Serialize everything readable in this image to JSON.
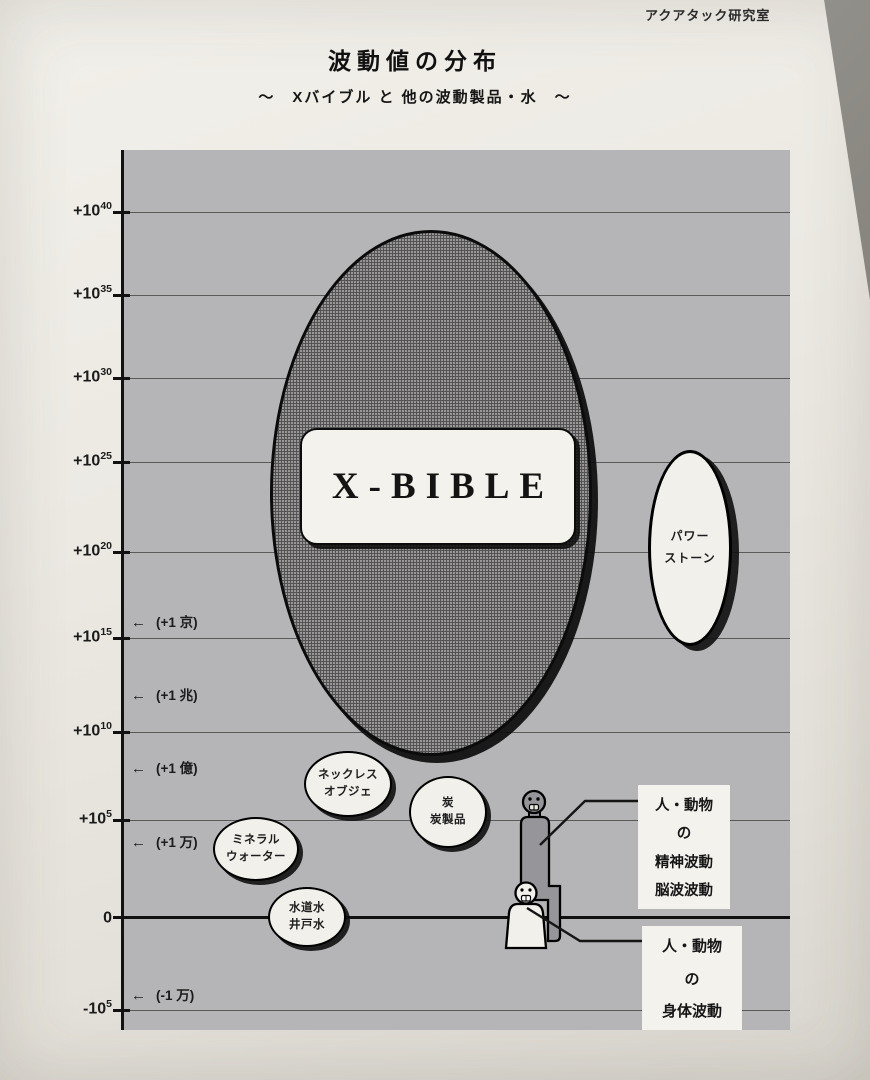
{
  "page": {
    "lab_name": "アクアタック研究室"
  },
  "header": {
    "title": "波動値の分布",
    "subtitle": "～　Xバイブル と 他の波動製品・水　～"
  },
  "y_axis": {
    "ticks": [
      {
        "base": "+10",
        "exp": "40"
      },
      {
        "base": "+10",
        "exp": "35"
      },
      {
        "base": "+10",
        "exp": "30"
      },
      {
        "base": "+10",
        "exp": "25"
      },
      {
        "base": "+10",
        "exp": "20"
      },
      {
        "base": "+10",
        "exp": "15"
      },
      {
        "base": "+10",
        "exp": "10"
      },
      {
        "base": "+10",
        "exp": "5"
      },
      {
        "base": "0",
        "exp": ""
      },
      {
        "base": "-10",
        "exp": "5"
      }
    ]
  },
  "unit_markers": [
    {
      "arrow": "←",
      "label": "(+1 京)"
    },
    {
      "arrow": "←",
      "label": "(+1 兆)"
    },
    {
      "arrow": "←",
      "label": "(+1 億)"
    },
    {
      "arrow": "←",
      "label": "(+1 万)"
    },
    {
      "arrow": "←",
      "label": "(-1 万)"
    }
  ],
  "items": {
    "xbible": {
      "label": "X-BIBLE"
    },
    "power_stone": {
      "line1": "パワー",
      "line2": "ストーン"
    },
    "necklace": {
      "line1": "ネックレス",
      "line2": "オブジェ"
    },
    "charcoal": {
      "line1": "炭",
      "line2": "炭製品"
    },
    "mineral_water": {
      "line1": "ミネラル",
      "line2": "ウォーター"
    },
    "tap_water": {
      "line1": "水道水",
      "line2": "井戸水"
    }
  },
  "callouts": {
    "mental": {
      "lines": [
        "人・動物",
        "の",
        "精神波動",
        "脳波波動"
      ]
    },
    "body": {
      "lines": [
        "人・動物",
        "の",
        "身体波動"
      ]
    }
  },
  "colors": {
    "paper": "#ece9e3",
    "plot_background": "#b5b4b7",
    "xbible_ellipse_fill": "#535356",
    "bubble_fill": "#f2f0ea",
    "ink": "#111111"
  },
  "chart_data": {
    "type": "scatter",
    "title": "波動値の分布",
    "subtitle": "～ Xバイブル と 他の波動製品・水 ～",
    "ylabel": "波動値",
    "y_scale": "log10, signed",
    "ylim_log10": [
      -5,
      40
    ],
    "grid": true,
    "y_ticks": [
      "+10^40",
      "+10^35",
      "+10^30",
      "+10^25",
      "+10^20",
      "+10^15",
      "+10^10",
      "+10^5",
      "0",
      "-10^5"
    ],
    "y_unit_annotations": [
      {
        "at": "+10^16",
        "label": "(+1 京)"
      },
      {
        "at": "+10^12",
        "label": "(+1 兆)"
      },
      {
        "at": "+10^8",
        "label": "(+1 億)"
      },
      {
        "at": "+10^4",
        "label": "(+1 万)"
      },
      {
        "at": "-10^4",
        "label": "(-1 万)"
      }
    ],
    "series": [
      {
        "name": "X-BIBLE",
        "shape": "large-ellipse",
        "range_log10": [
          9,
          39
        ]
      },
      {
        "name": "パワーストーン",
        "shape": "ellipse",
        "range_log10": [
          15,
          26
        ]
      },
      {
        "name": "ネックレス オブジェ",
        "shape": "circle",
        "range_log10": [
          5,
          9
        ]
      },
      {
        "name": "炭 炭製品",
        "shape": "circle",
        "range_log10": [
          3,
          7.5
        ]
      },
      {
        "name": "ミネラルウォーター",
        "shape": "circle",
        "range_log10": [
          2,
          5
        ]
      },
      {
        "name": "水道水 井戸水",
        "shape": "circle",
        "range_log10": [
          -2,
          2
        ]
      },
      {
        "name": "人・動物の精神波動 脳波波動",
        "shape": "human-figure",
        "range_log10": [
          1,
          6.5
        ]
      },
      {
        "name": "人・動物の身体波動",
        "shape": "human-figure",
        "range_log10": [
          -2,
          2
        ]
      }
    ]
  }
}
